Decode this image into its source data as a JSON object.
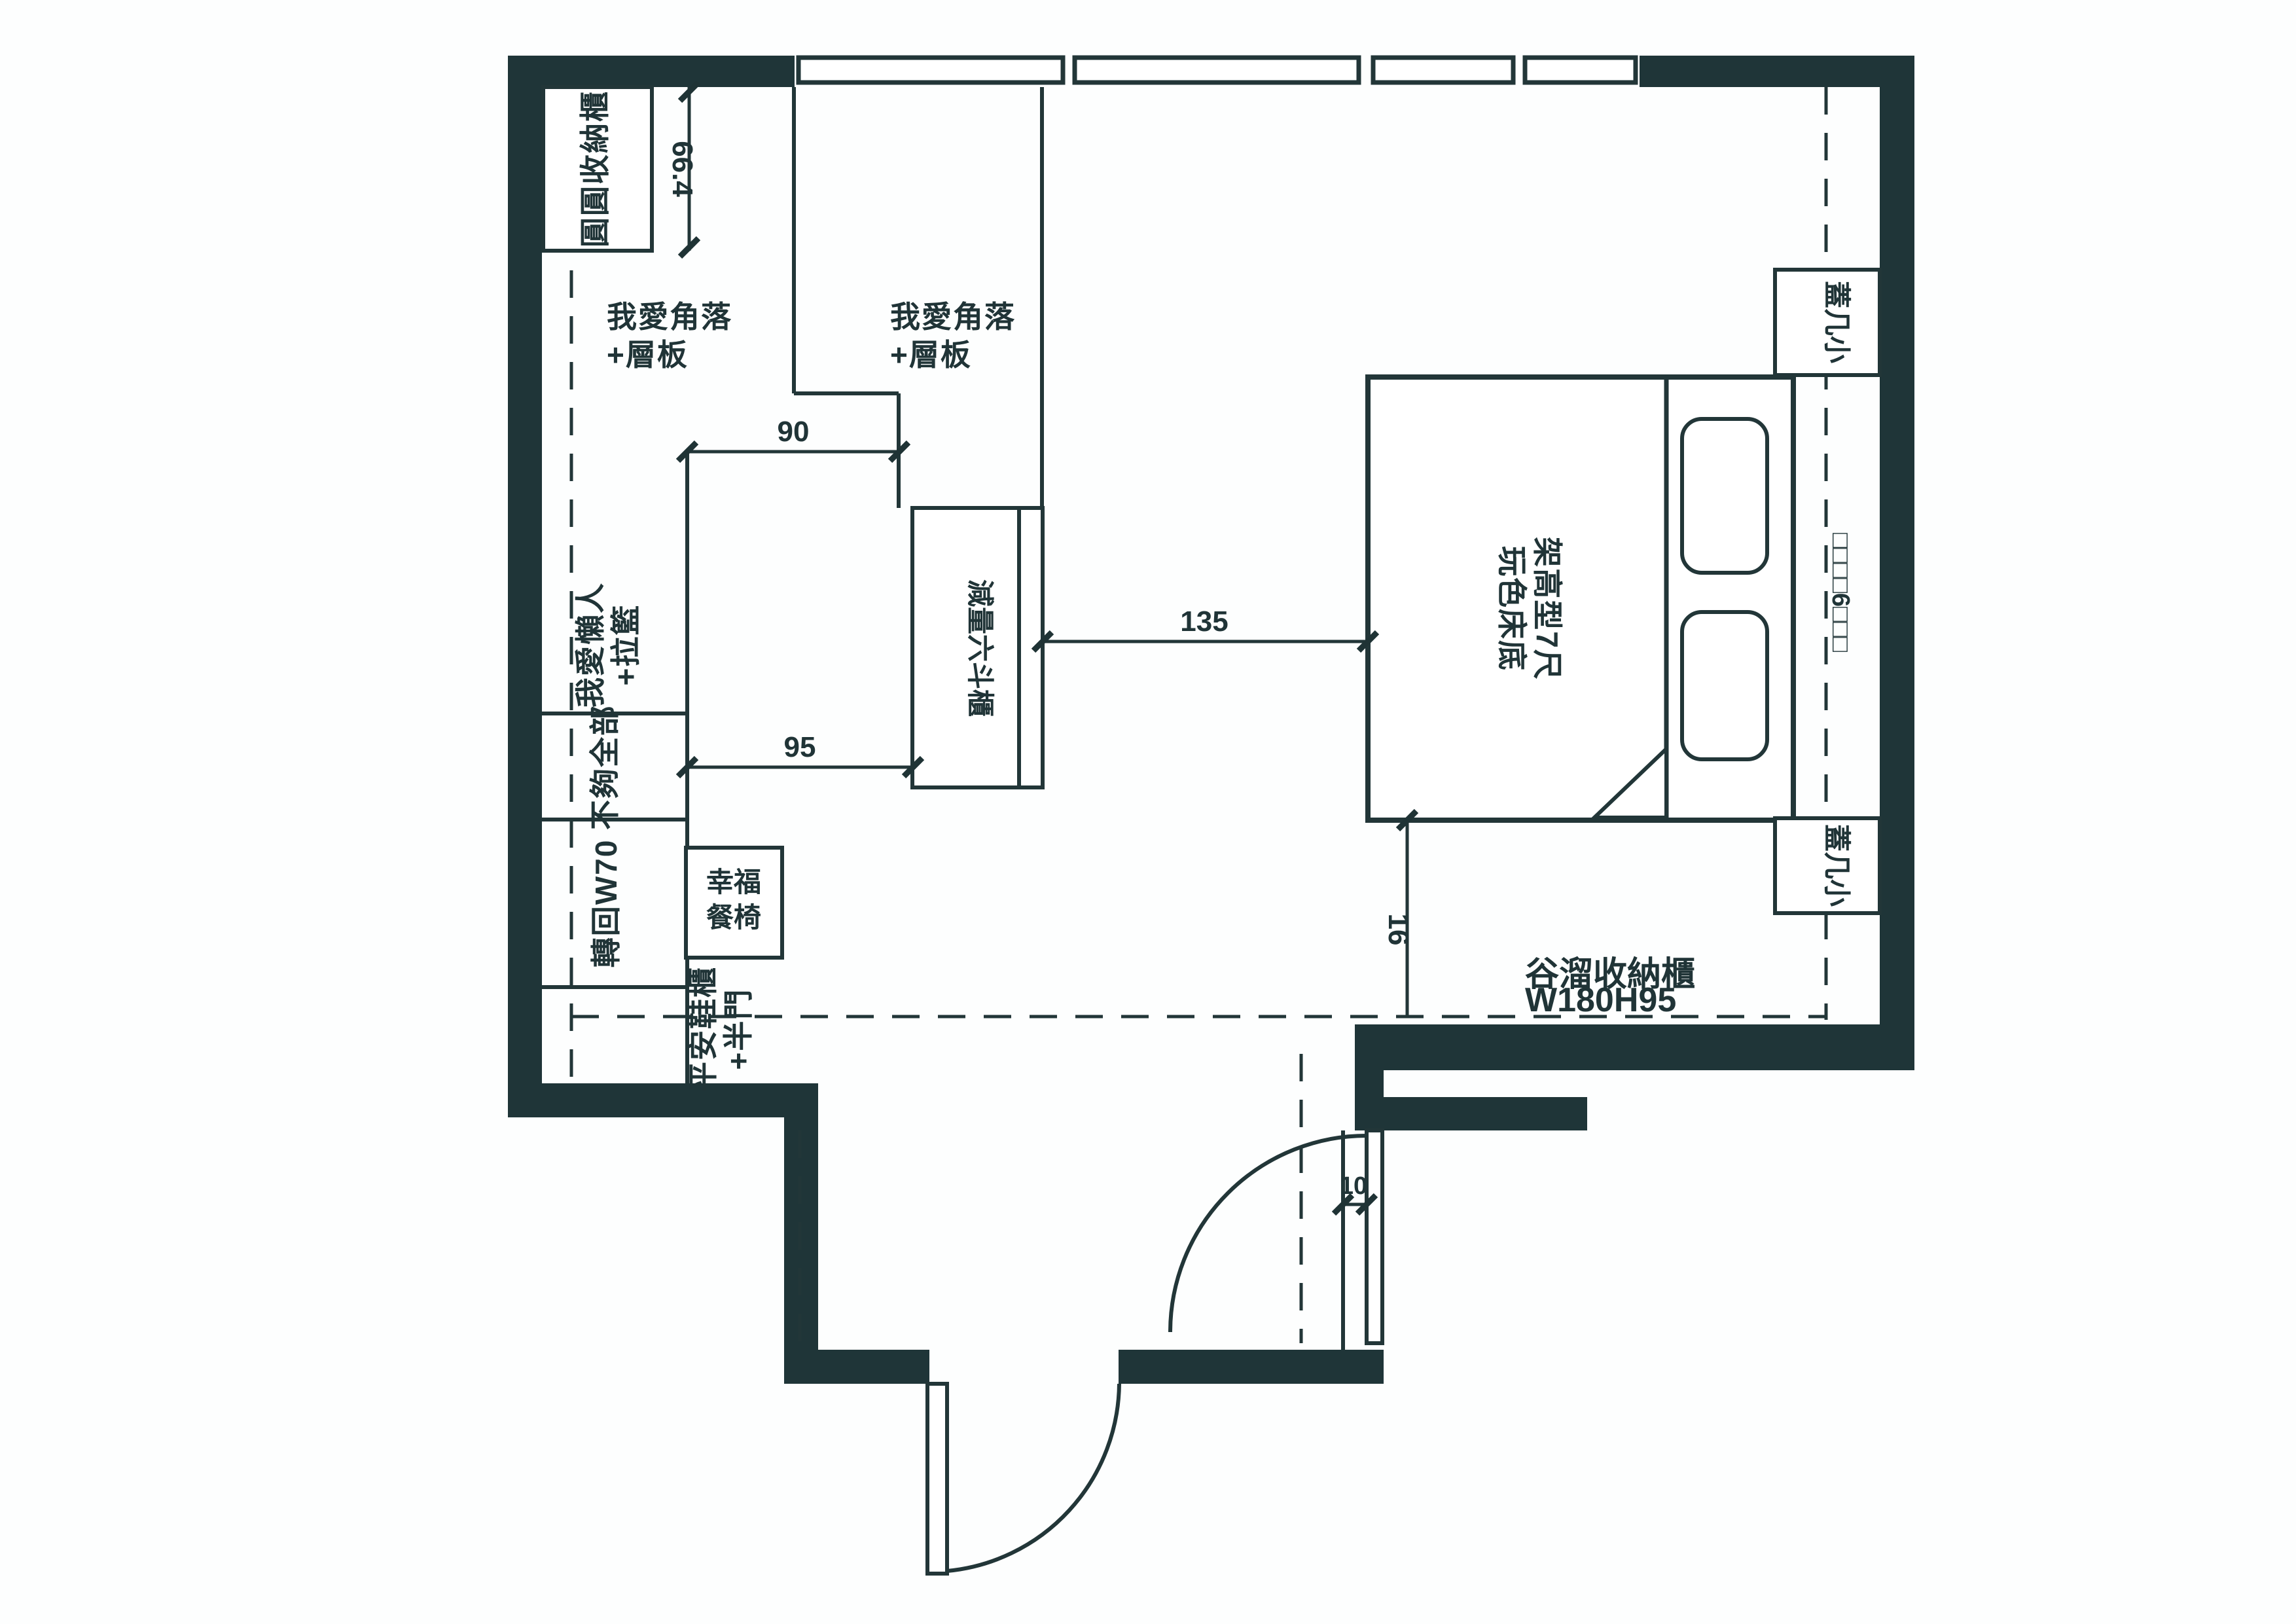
{
  "title": "bedroom-floor-plan",
  "colors": {
    "wall": "#1f3538",
    "line": "#223638",
    "text": "#203437",
    "background": "#ffffff"
  },
  "labels": {
    "round_cabinet": "圓圓收納櫃",
    "corner_shelf_line1": "我愛角落",
    "corner_shelf_line2": "+層板",
    "lazy_line1": "我愛懶人",
    "lazy_line2": "+拉籃",
    "hang_all": "不夠全部",
    "w70_unit": "轉回W70",
    "chair_line1": "幸福",
    "chair_line2": "餐椅",
    "shoe_line1": "平安鞋櫃",
    "shoe_line2": "+半門",
    "dresser": "減量六斗櫃",
    "bed_line1": "架高型7尺",
    "bed_line2": "玩色床底",
    "side_table_top": "蓋几小",
    "side_table_bottom": "蓋几小",
    "barn_line1": "谷溜收納櫃",
    "barn_line2": "W180H95",
    "window_marks": "□□□□6□□□"
  },
  "dimensions": {
    "cabinet_width": "66.4",
    "closet_width": "90",
    "closet_depth": "95",
    "walkway": "135",
    "bed_gap": "16",
    "door_jamb": "10"
  }
}
